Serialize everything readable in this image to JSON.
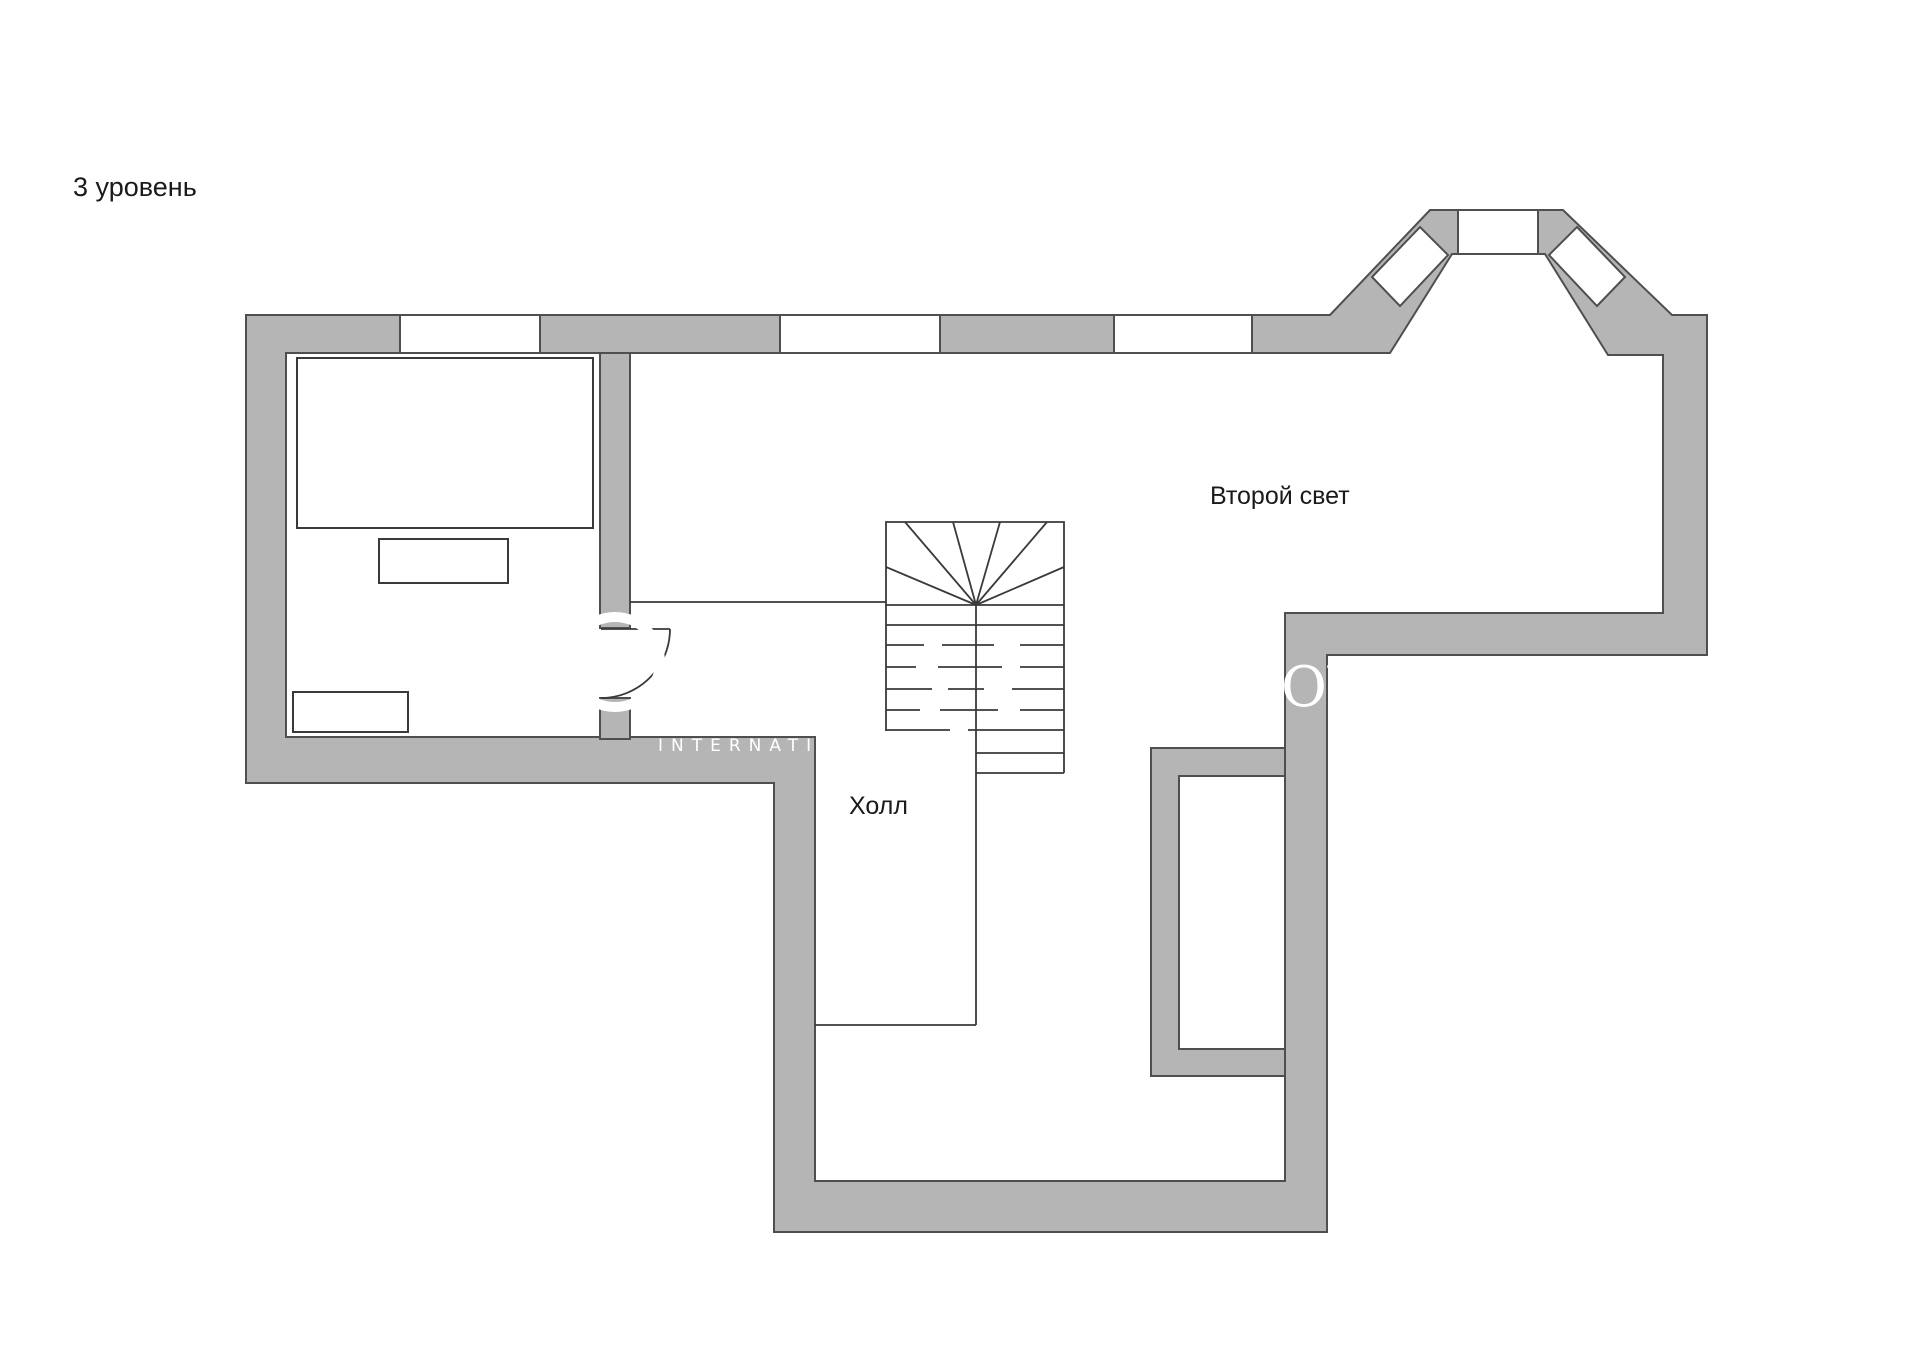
{
  "page": {
    "title": "3 уровень"
  },
  "rooms": {
    "second_light_label": "Второй свет",
    "hall_label": "Холл"
  },
  "watermark": {
    "caps_text": "INTERNATIONAL",
    "serif_text": "OV"
  },
  "colors": {
    "background": "#ffffff",
    "wall_fill": "#b5b5b5",
    "wall_stroke": "#4f4f4f",
    "line": "#3a3a3a",
    "text": "#1a1a1a",
    "watermark": "#ffffff"
  }
}
